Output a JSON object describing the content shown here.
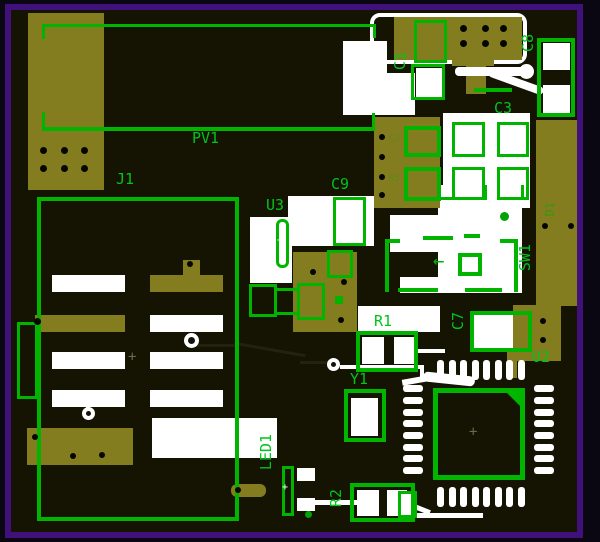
{
  "window": {
    "view": "pcb-board-layout"
  },
  "colors": {
    "board_background": "#151301",
    "copper": "#837d20",
    "silkscreen_white": "#ffffff",
    "overlay_green": "#00b400",
    "label_green": "#00c41c",
    "frame_purple": "#40117a",
    "hole_black": "#060600"
  },
  "board": {
    "reference_designators": [
      {
        "id": "PV1",
        "text": "PV1",
        "orientation": "horizontal"
      },
      {
        "id": "J1",
        "text": "J1",
        "orientation": "horizontal"
      },
      {
        "id": "C1",
        "text": "C1",
        "orientation": "vertical"
      },
      {
        "id": "C8",
        "text": "C8",
        "orientation": "vertical"
      },
      {
        "id": "C3",
        "text": "C3",
        "orientation": "horizontal"
      },
      {
        "id": "C9",
        "text": "C9",
        "orientation": "horizontal"
      },
      {
        "id": "U3",
        "text": "U3",
        "orientation": "horizontal"
      },
      {
        "id": "C2",
        "text": "C2",
        "orientation": "horizontal",
        "faint": true
      },
      {
        "id": "R5",
        "text": "R5",
        "orientation": "horizontal",
        "faint": true
      },
      {
        "id": "D1",
        "text": "D1",
        "orientation": "vertical",
        "faint": true
      },
      {
        "id": "SW1",
        "text": "SW1",
        "orientation": "vertical"
      },
      {
        "id": "C7",
        "text": "C7",
        "orientation": "vertical"
      },
      {
        "id": "R1",
        "text": "R1",
        "orientation": "horizontal"
      },
      {
        "id": "U2",
        "text": "U2",
        "orientation": "horizontal"
      },
      {
        "id": "Y1",
        "text": "Y1",
        "orientation": "horizontal"
      },
      {
        "id": "LED1",
        "text": "LED1",
        "orientation": "vertical"
      },
      {
        "id": "R2",
        "text": "R2",
        "orientation": "vertical"
      }
    ],
    "arrow_glyph": "←",
    "plus_glyph": "+"
  }
}
